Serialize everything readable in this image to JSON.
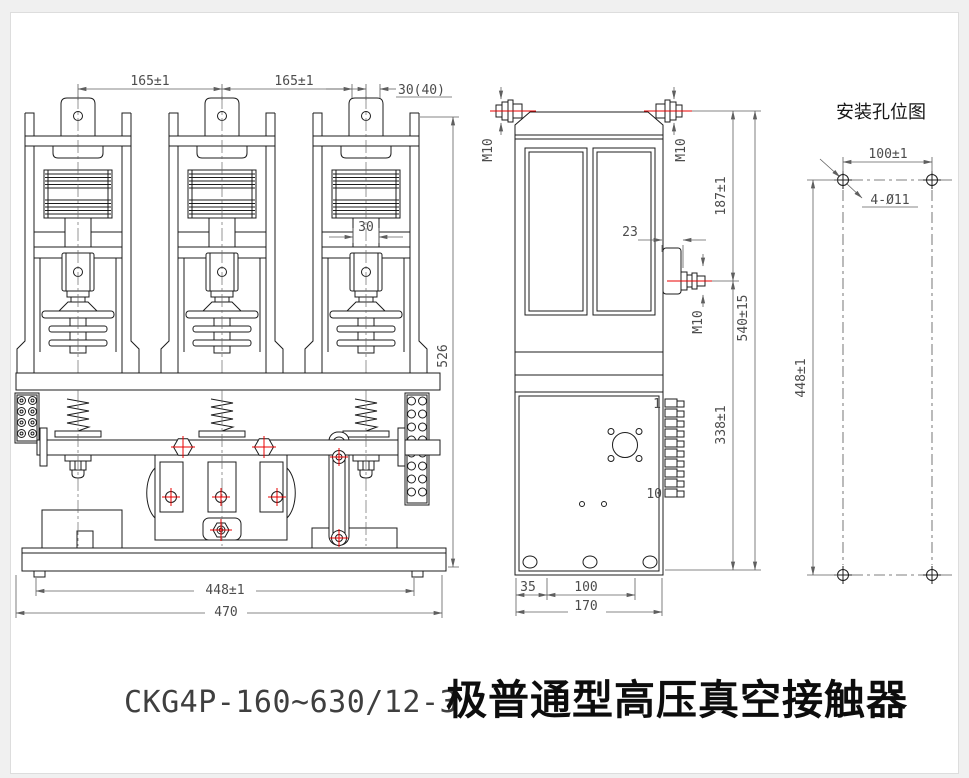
{
  "drawing": {
    "title_model": "CKG4P-160~630/12-3",
    "title_name": "极普通型高压真空接触器",
    "front_view": {
      "dim_pole_spacing_left": "165±1",
      "dim_pole_spacing_right": "165±1",
      "dim_tab_width": "30(40)",
      "dim_neck_width": "30",
      "dim_height": "526",
      "dim_hole_span": "448±1",
      "dim_overall_width": "470"
    },
    "side_view": {
      "thread_top_left": "M10",
      "thread_top_right": "M10",
      "dim_upper_terminal_height": "187±1",
      "dim_bracket_offset": "23",
      "thread_mid": "M10",
      "dim_overall_height": "540±15",
      "dim_lower_height": "338±1",
      "terminal_first": "1",
      "terminal_last": "10",
      "dim_foot_offset": "35",
      "dim_foot_span": "100",
      "dim_depth": "170"
    },
    "mounting_diagram": {
      "title": "安装孔位图",
      "dim_hole_span_x": "100±1",
      "holes_label": "4-Ø11",
      "dim_hole_span_y": "448±1"
    },
    "colors": {
      "line": "#1c1c1c",
      "dimension": "#5f5f5f",
      "accent_red": "#e80000",
      "canvas": "#ffffff",
      "frame": "#f0f0f0"
    }
  }
}
